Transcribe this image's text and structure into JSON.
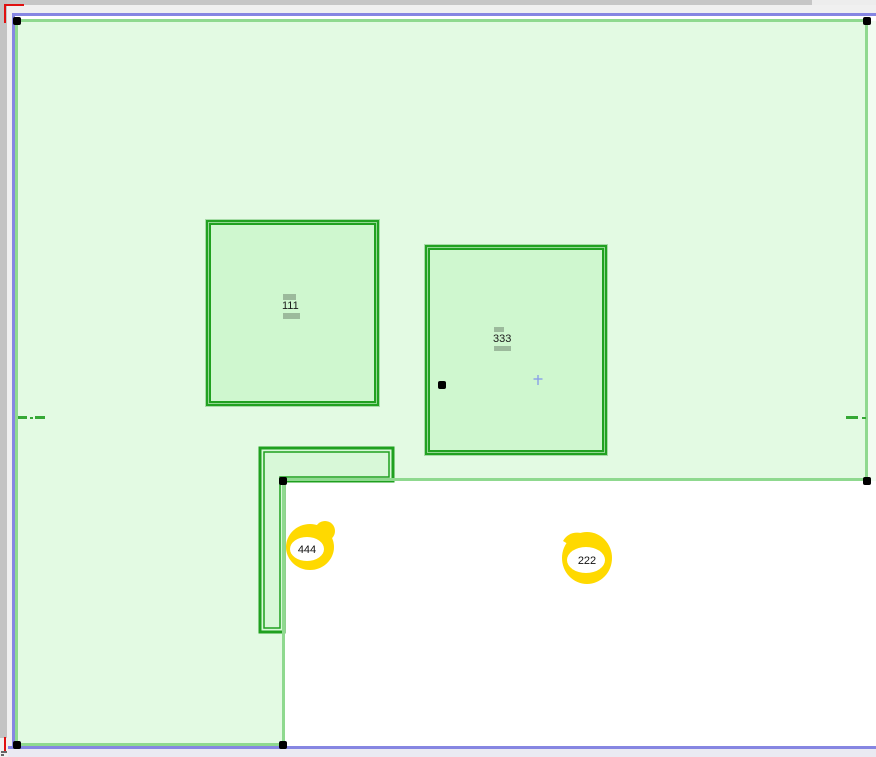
{
  "canvas_title": "Floor plan drawing canvas",
  "labels": {
    "room_a": "111",
    "room_b": "333",
    "mark_a": "444",
    "mark_b": "222"
  },
  "colors": {
    "selection_outline": "#8686e2",
    "polygon_edge": "#8fd98f",
    "polygon_fill": "#e3fae3",
    "room_fill": "#cff7cf",
    "room_border": "#21a121",
    "wall_piece_fill": "#d8f8d8",
    "highlight": "#ffd900",
    "origin_marker": "#e01010",
    "vertex_handle": "#000000",
    "label_bar": "#9cba9c",
    "cursor_cross": "#8aa0e8"
  }
}
